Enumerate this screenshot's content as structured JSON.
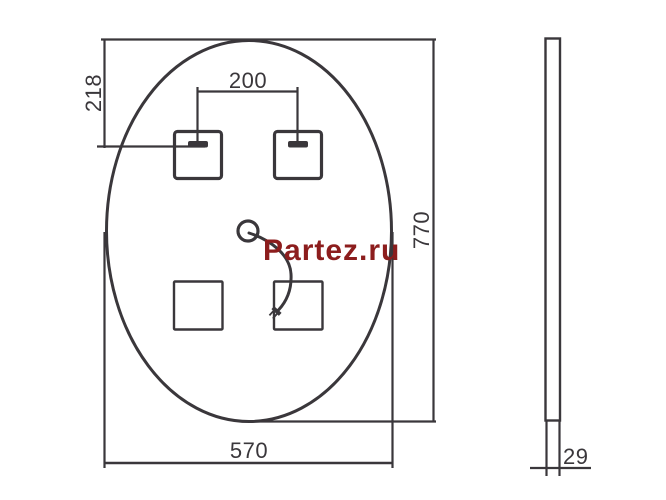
{
  "canvas": {
    "background": "#ffffff",
    "line_color": "#3a373b",
    "text_color": "#3a373b"
  },
  "watermark": {
    "text": "Partez.ru",
    "color": "#8c1d1d"
  },
  "dimensions": {
    "mount_offset_top": "218",
    "mount_spacing": "200",
    "height": "770",
    "width": "570",
    "thickness": "29"
  }
}
